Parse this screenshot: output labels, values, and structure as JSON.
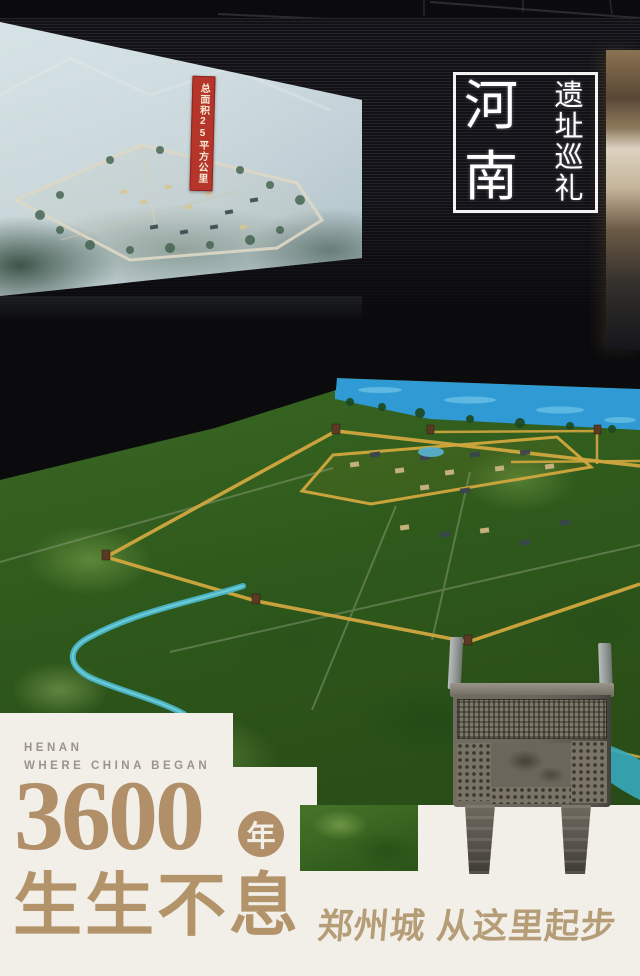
{
  "page": {
    "kind": "museum exhibit promotional photo",
    "subject": "Zhengzhou ancient city diorama, Henan heritage exhibition"
  },
  "seal": {
    "main_chars": [
      "河",
      "南"
    ],
    "column_chars": [
      "遗",
      "址",
      "巡",
      "礼"
    ]
  },
  "screen": {
    "banner_text": "总面积25平方公里"
  },
  "footer": {
    "eyebrow_line1": "HENAN",
    "eyebrow_line2": "WHERE CHINA BEGAN",
    "big_number": "3600",
    "year_char": "年",
    "slogan": "生生不息",
    "tagline": "郑州城 从这里起步"
  },
  "colors": {
    "accent_gold": "#b19069",
    "slogan_gold": "#b3946a",
    "tagline_gold": "#b59d77",
    "eyebrow_gray": "#9a948b",
    "panel_white": "#f2efe9",
    "banner_red": "#b5352a",
    "wall_yellow": "#d2a73f",
    "water_blue": "#2f9ad4",
    "river_teal": "#4ab6c8"
  }
}
